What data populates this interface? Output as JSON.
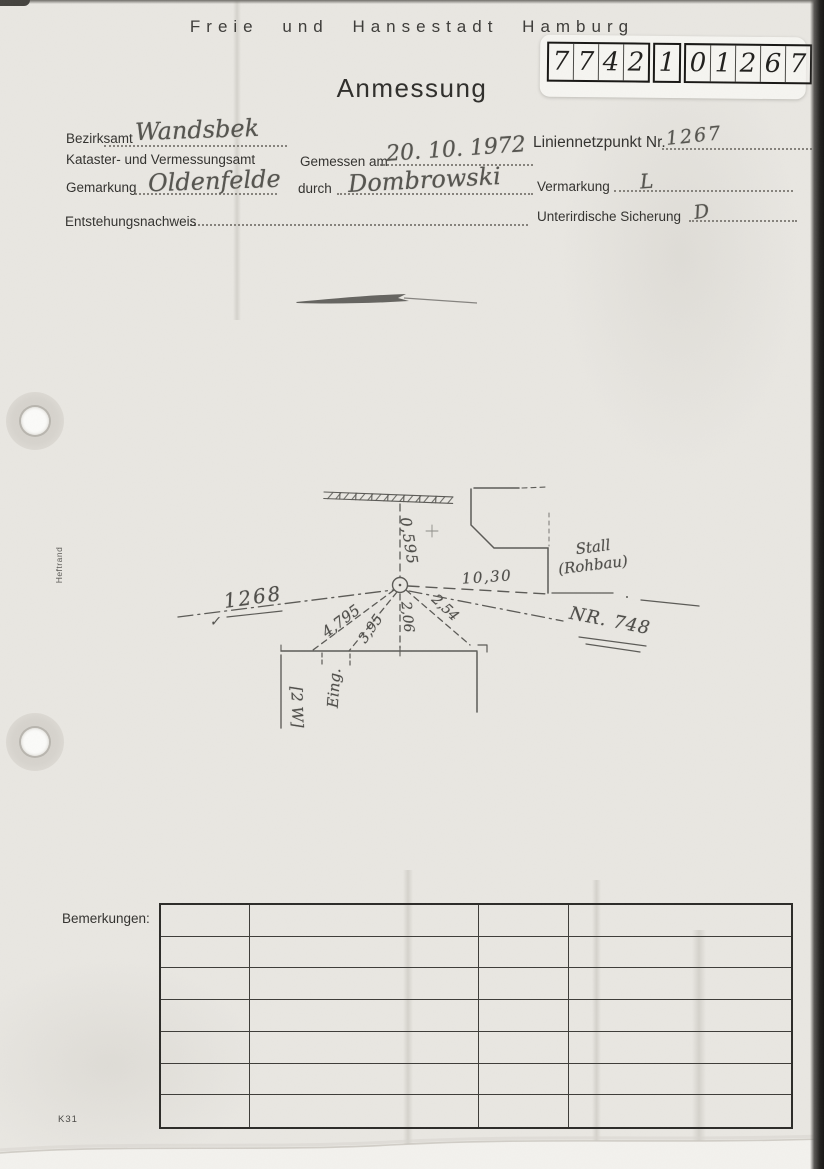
{
  "colors": {
    "paper": "#e9e7e2",
    "ink": "#2e2d2b",
    "pencil": "#565553"
  },
  "header": {
    "title": "Freie und Hansestadt Hamburg",
    "form_title": "Anmessung"
  },
  "stamp": {
    "group1": [
      "7",
      "7",
      "4",
      "2"
    ],
    "group2": [
      "1"
    ],
    "group3": [
      "0",
      "1",
      "2",
      "6",
      "7"
    ]
  },
  "fields": {
    "bezirksamt": {
      "label": "Bezirksamt",
      "value": "Wandsbek"
    },
    "kataster": {
      "label": "Kataster- und Vermessungsamt"
    },
    "gemessen": {
      "label": "Gemessen am",
      "value": "20. 10. 1972"
    },
    "liniennetzpunkt": {
      "label": "Liniennetzpunkt Nr.",
      "value": "1267"
    },
    "gemarkung": {
      "label": "Gemarkung",
      "value": "Oldenfelde"
    },
    "durch": {
      "label": "durch",
      "value": "Dombrowski"
    },
    "vermarkung": {
      "label": "Vermarkung",
      "value": "L"
    },
    "entstehungsnachweis": {
      "label": "Entstehungsnachweis",
      "value": ""
    },
    "sicherung": {
      "label": "Unterirdische Sicherung",
      "value": "D"
    }
  },
  "sketch": {
    "dimensions": {
      "top_offset": "0,595",
      "to_stall": "10,30",
      "house_1": "4,795",
      "house_2": "3,95",
      "house_3": "2,06",
      "house_4": "2,54"
    },
    "labels": {
      "point_left": "1268",
      "check_mark": "✓",
      "boundary_right": "NR. 748",
      "stall_line1": "Stall",
      "stall_line2": "(Rohbau)",
      "entrance": "Eing.",
      "storeys": "[2 W]"
    }
  },
  "remarks": {
    "label": "Bemerkungen:",
    "rows": 7,
    "cols": 4
  },
  "footer": {
    "form_code": "K31",
    "margin_label": "Heftrand"
  }
}
